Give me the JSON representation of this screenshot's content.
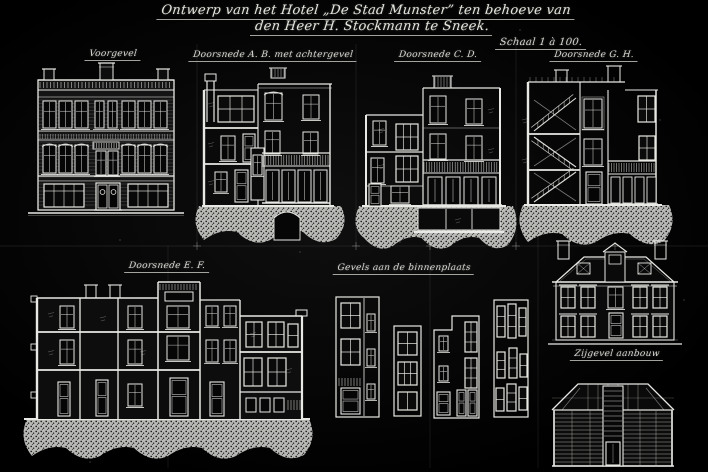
{
  "sheet": {
    "title_line1": "Ontwerp van het Hotel „De Stad Munster” ten behoeve van",
    "title_line2": "den Heer H. Stockmann te Sneek.",
    "scale_note": "Schaal 1 à 100.",
    "ink_color": "#e8e8e4",
    "background_color": "#070707",
    "stipple_color": "#c8c8c5",
    "labels": {
      "voorgevel": "Voorgevel",
      "doorsnede_ab": "Doorsnede A. B. met achtergevel",
      "doorsnede_cd": "Doorsnede C. D.",
      "doorsnede_gh": "Doorsnede G. H.",
      "doorsnede_ef": "Doorsnede E. F.",
      "binnenplaats": "Gevels aan de binnenplaats",
      "aanbouw": "Zijgevel aanbouw"
    }
  }
}
